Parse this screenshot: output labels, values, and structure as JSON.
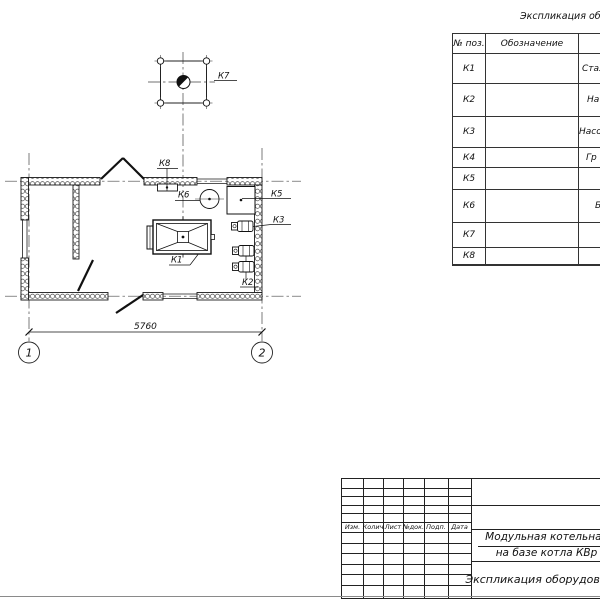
{
  "equipment_table": {
    "title": "Экспликация оборудования",
    "headers": [
      "№ поз.",
      "Обозначение",
      ""
    ],
    "rows": [
      {
        "pos": "К1",
        "designation": "",
        "name": "Стал"
      },
      {
        "pos": "К2",
        "designation": "",
        "name": "На"
      },
      {
        "pos": "К3",
        "designation": "",
        "name": "Насос"
      },
      {
        "pos": "К4",
        "designation": "",
        "name": "Гр"
      },
      {
        "pos": "К5",
        "designation": "",
        "name": ""
      },
      {
        "pos": "К6",
        "designation": "",
        "name": "Б"
      },
      {
        "pos": "К7",
        "designation": "",
        "name": ""
      },
      {
        "pos": "К8",
        "designation": "",
        "name": ""
      }
    ]
  },
  "plan": {
    "labels": {
      "k1": "К1",
      "k2": "К2",
      "k3": "К3",
      "k5": "К5",
      "k6": "К6",
      "k7": "К7",
      "k8": "К8"
    },
    "dimension_width": "5760",
    "axis_1": "1",
    "axis_2": "2"
  },
  "title_block": {
    "columns": [
      "Изм.",
      "Колич",
      "Лист",
      "№док.",
      "Подп.",
      "Дата"
    ],
    "project_title_line1": "Модульная котельная",
    "project_title_line2": "на базе котла КВр",
    "document_name": "Экспликация оборудования"
  },
  "colors": {
    "line": "#1a1a1a",
    "centerline": "#444",
    "frame": "#8a8a8a"
  }
}
